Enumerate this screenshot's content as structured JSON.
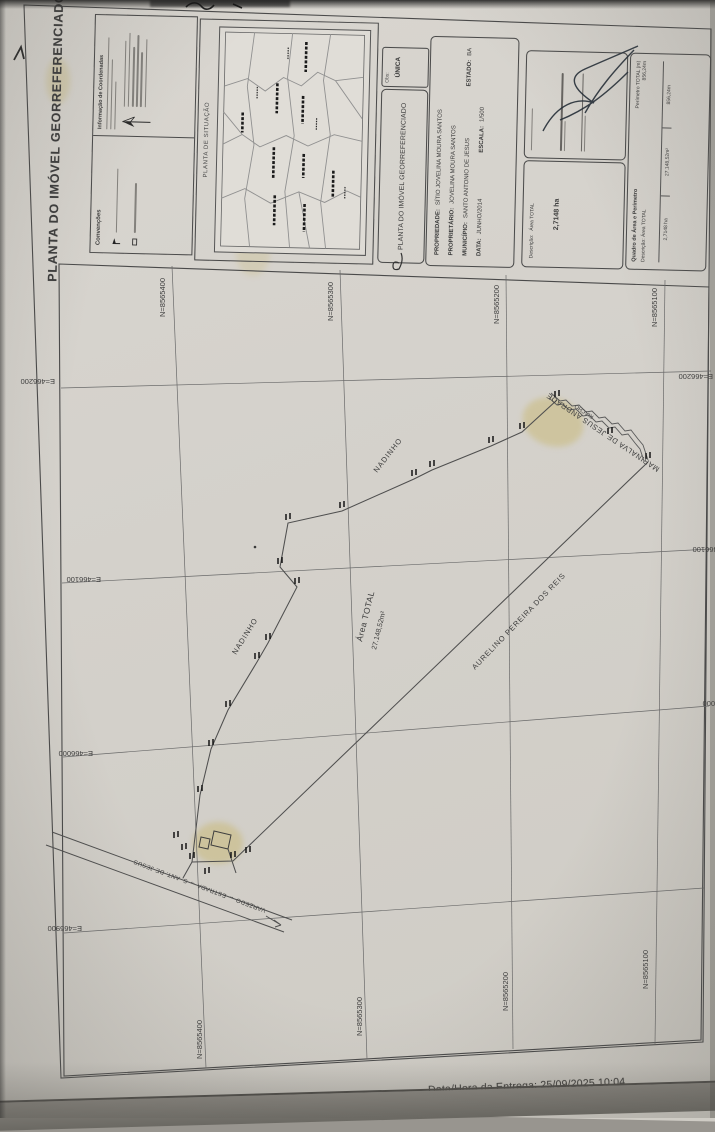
{
  "document": {
    "side_title": "PLANTA DO IMÓVEL GEORREFERENCIADO",
    "coord_info": {
      "title": "Informação de Coordenadas"
    },
    "conventions": {
      "title": "Convenções"
    },
    "situation_map": {
      "title": "PLANTA DE SITUAÇÃO"
    },
    "obs": {
      "label": "Obs:",
      "value": "ÚNICA"
    },
    "doc_type": "PLANTA DO IMÓVEL GEORREFERENCIADO",
    "property": {
      "rows": [
        {
          "label": "PROPRIEDADE:",
          "value": "SÍTIO JOVELINA MOURA SANTOS"
        },
        {
          "label": "PROPRIETÁRIO:",
          "value": "JOVELINA MOURA SANTOS"
        },
        {
          "label": "MUNICÍPIO:",
          "value": "SANTO ANTONIO DE JESUS",
          "label2": "ESTADO:",
          "value2": "BA"
        },
        {
          "label": "DATA:",
          "value": "JUNHO/2014",
          "label2": "ESCALA:",
          "value2": "1/500"
        }
      ]
    },
    "description_box": {
      "label": "Descrição:",
      "value": "Área TOTAL",
      "area": "2,7148 ha"
    },
    "area_table": {
      "title": "Quadro de Área e Perímetro",
      "subtitle": "Descrição:  Área TOTAL",
      "perimeter_label": "Perímetro TOTAL (m)",
      "cells": [
        "2,7148 ha",
        "27.148,52m²",
        "856,24m"
      ]
    }
  },
  "plot": {
    "area_label": {
      "line1": "Área TOTAL",
      "line2": "27.148,52m²"
    },
    "labels": {
      "nadinho": "NADINHO",
      "aurelino": "AURELINO PEREIRA DOS REIS",
      "marinalva": "MARINALVA DE JESUS ANDRADE",
      "riacho": "RIACHO",
      "road": "VARZEDO  ←  ESTRADA  →  S. ANT. DE JESUS"
    },
    "grid": {
      "north": [
        "N=8565400",
        "N=8565300",
        "N=8565200",
        "N=8565100"
      ],
      "east": [
        "E=466200",
        "E=466100",
        "E=466000",
        "E=465900"
      ]
    }
  },
  "photo": {
    "delivery_stamp": "Data/Hora da Entrega: 25/09/2025 10:04"
  },
  "colors": {
    "paper": "#d6d3cd",
    "ink": "#3c3c3c",
    "stain": "#c8b25e"
  }
}
